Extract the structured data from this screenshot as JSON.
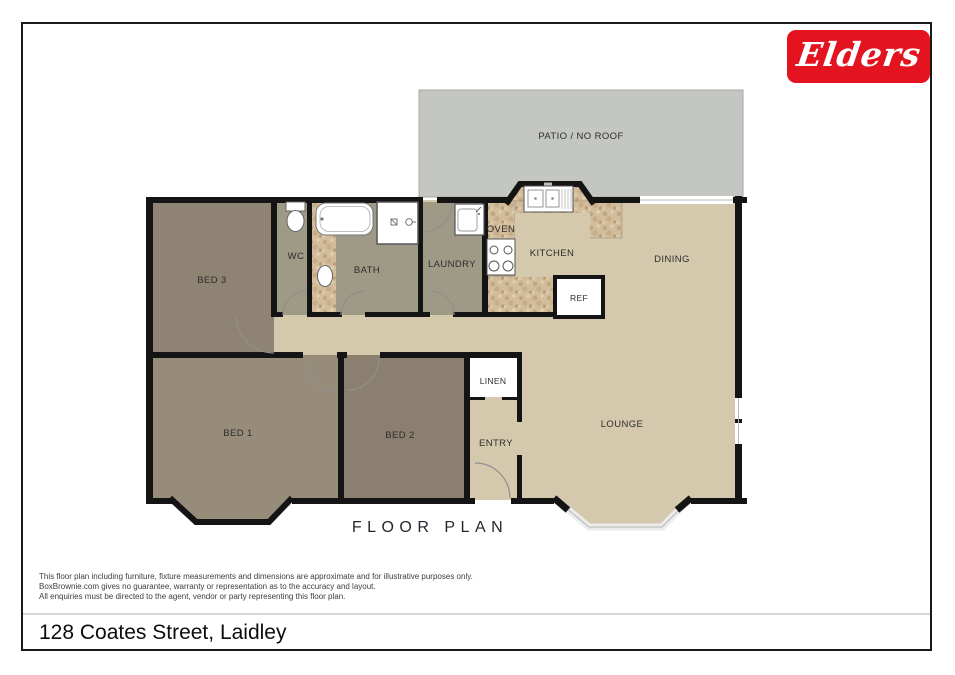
{
  "page": {
    "logo_text": "Elders",
    "title": "FLOOR PLAN",
    "address": "128 Coates Street, Laidley",
    "disclaimer_line1": "This floor plan including furniture, fixture measurements and dimensions are approximate and for illustrative purposes only.",
    "disclaimer_line2": "BoxBrownie.com gives no guarantee, warranty or representation as to the accuracy and layout.",
    "disclaimer_line3": "All enquiries must be directed to the agent, vendor or party representing this floor plan."
  },
  "plan": {
    "labels": {
      "patio": "PATIO / NO ROOF",
      "bed1": "BED 1",
      "bed2": "BED 2",
      "bed3": "BED 3",
      "wc": "WC",
      "bath": "BATH",
      "laundry": "LAUNDRY",
      "oven": "OVEN",
      "kitchen": "KITCHEN",
      "dining": "DINING",
      "ref": "REF",
      "linen": "LINEN",
      "entry": "ENTRY",
      "lounge": "LOUNGE"
    }
  },
  "colors": {
    "logo_red": "#e31420",
    "wall_black": "#141414",
    "patio_gray": "#c4c7c1",
    "floor_tan": "#d5c9ad",
    "bed1_floor": "#978c79",
    "bed2_floor": "#8b8070",
    "bed3_floor": "#8f8473",
    "wet_area_floor": "#9e9a85",
    "counter_speckle_base": "#d2bc9c"
  }
}
